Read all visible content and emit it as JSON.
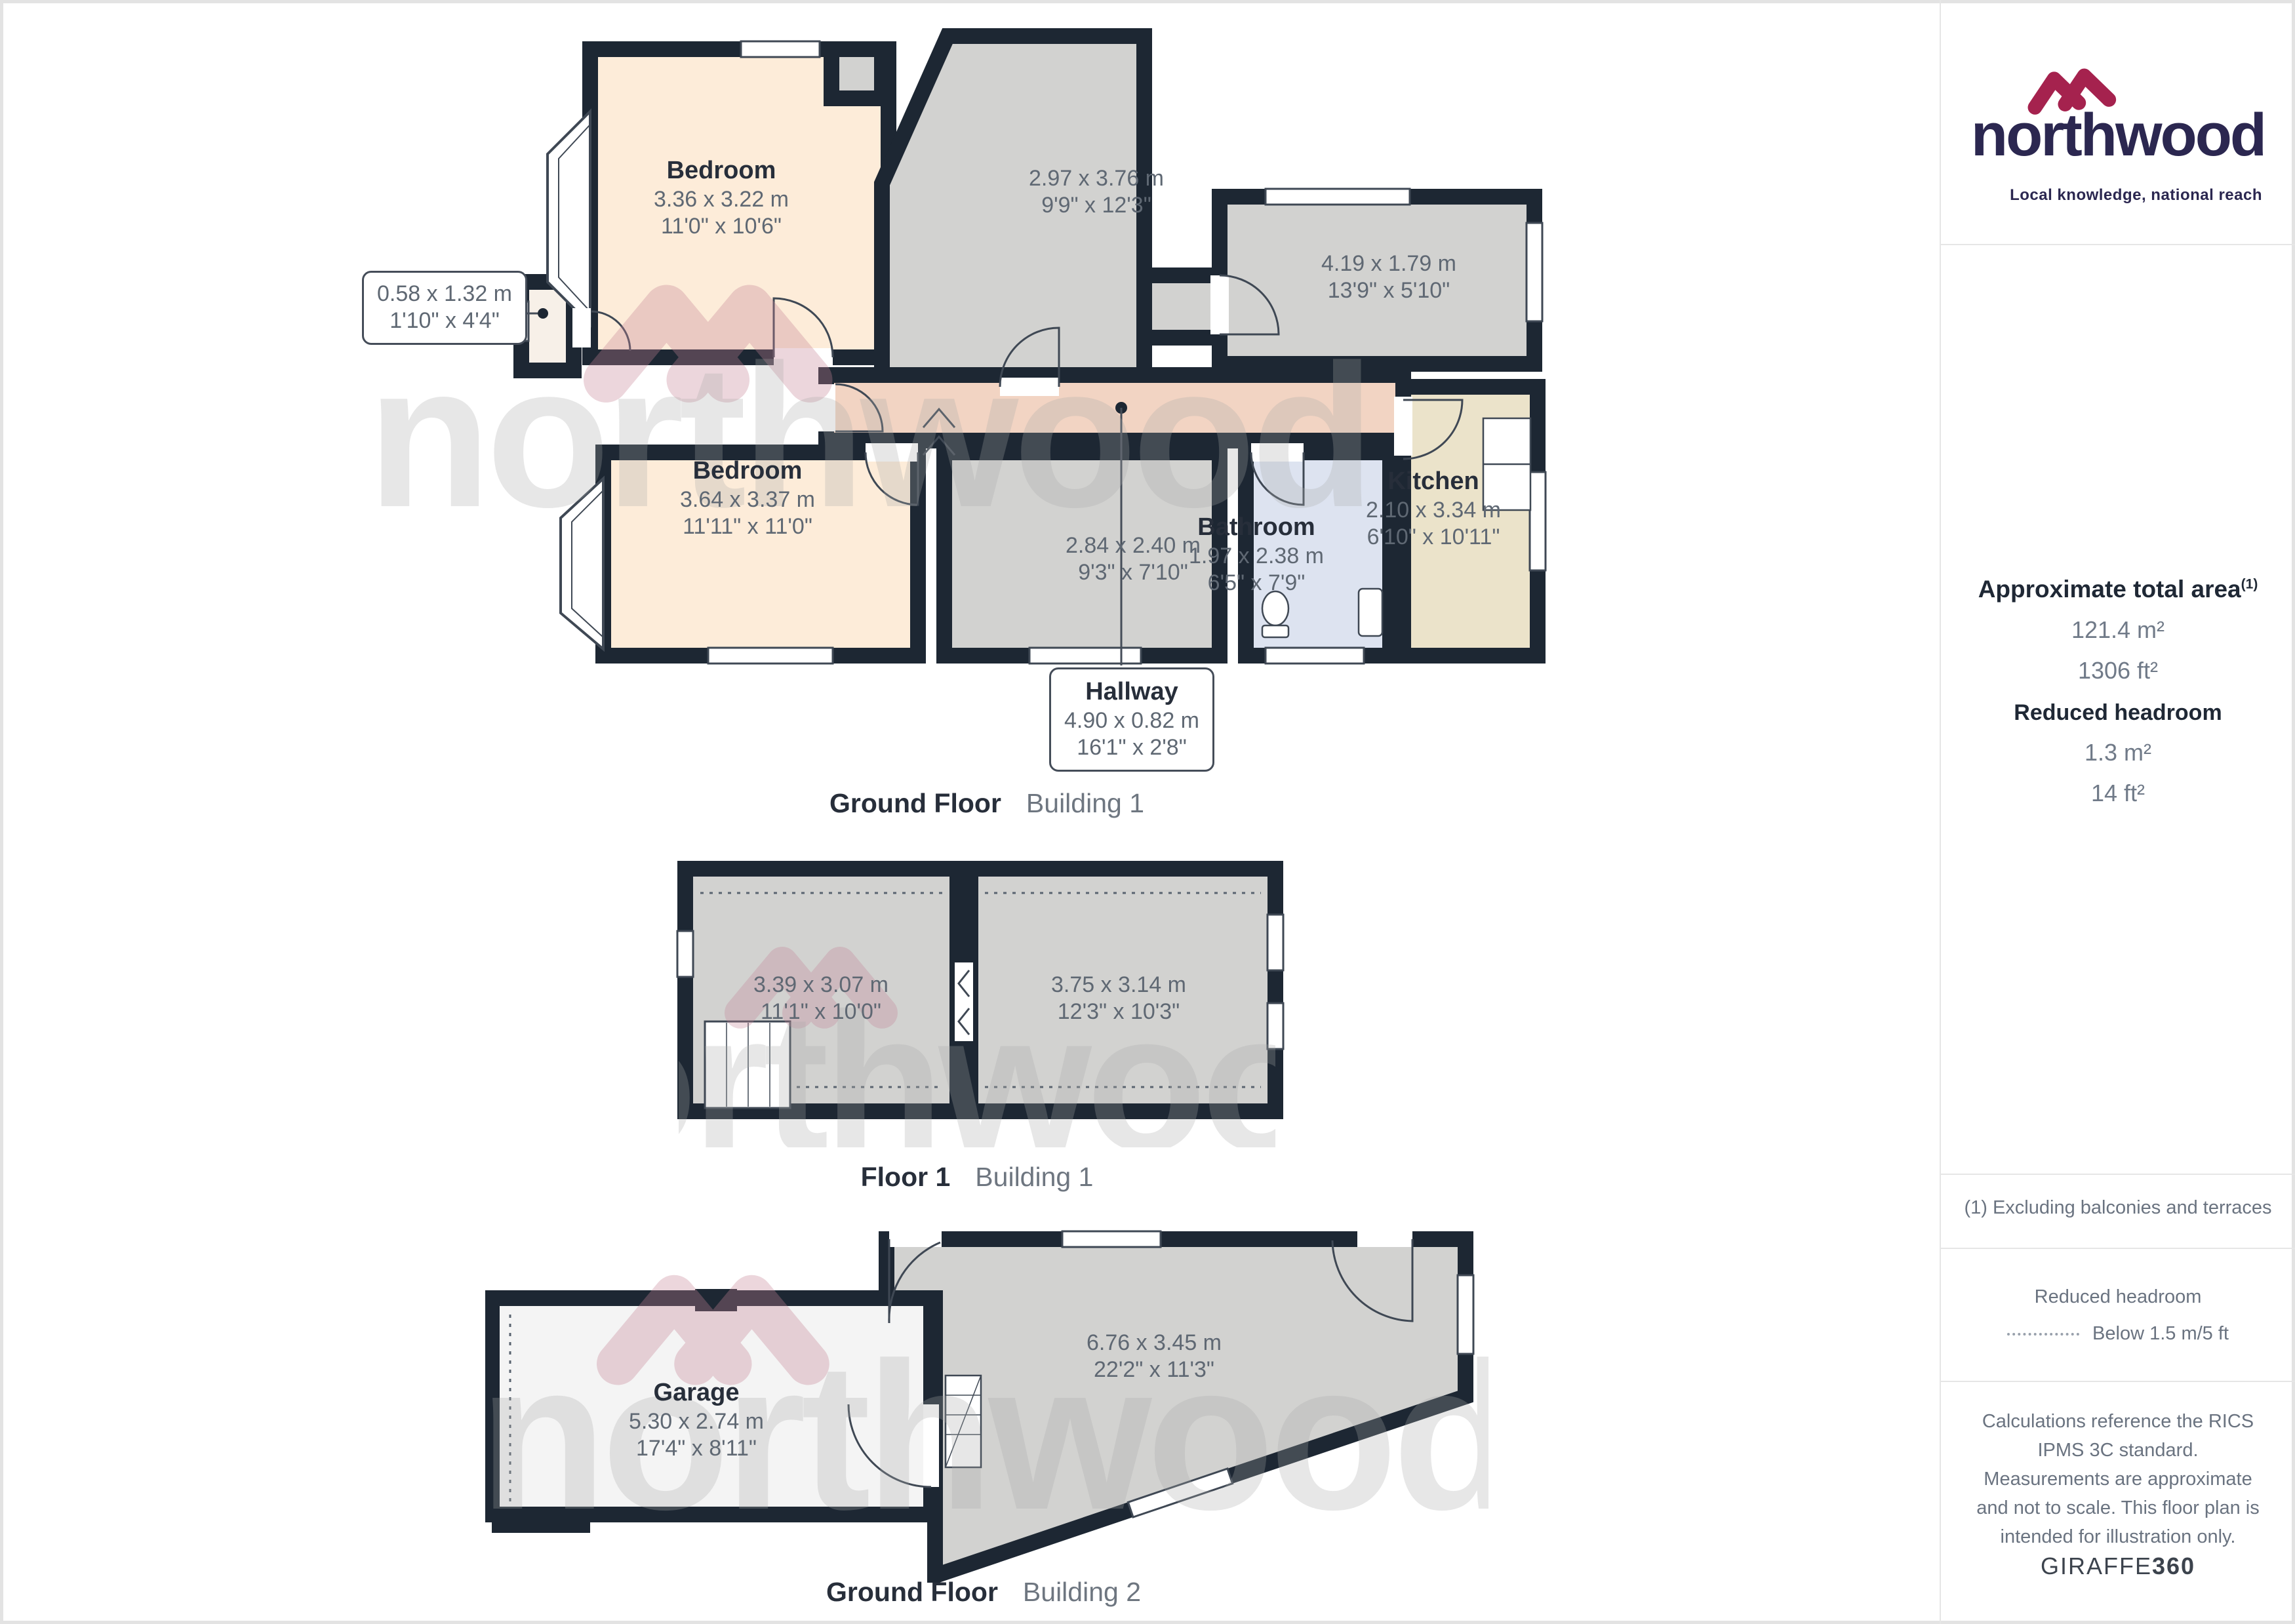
{
  "brand": {
    "name": "northwood",
    "tagline": "Local knowledge, national reach",
    "navy": "#2b2750",
    "crimson": "#a5224e"
  },
  "sidebar": {
    "total_area": {
      "title": "Approximate total area",
      "marker": "(1)",
      "metric": "121.4 m²",
      "imperial": "1306 ft²"
    },
    "reduced_headroom": {
      "title": "Reduced headroom",
      "metric": "1.3 m²",
      "imperial": "14 ft²"
    },
    "footnote": "(1) Excluding balconies and terraces",
    "legend": {
      "title": "Reduced headroom",
      "entry": "Below 1.5 m/5 ft"
    },
    "disclaimer": "Calculations reference the RICS IPMS 3C standard. Measurements are approximate and not to scale. This floor plan is intended for illustration only.",
    "credit_normal": "GIRAFFE",
    "credit_bold": "360"
  },
  "captions": [
    {
      "bold": "Ground Floor",
      "light": "Building 1"
    },
    {
      "bold": "Floor 1",
      "light": "Building 1"
    },
    {
      "bold": "Ground Floor",
      "light": "Building 2"
    }
  ],
  "rooms": {
    "gf1_bedroom1": {
      "name": "Bedroom",
      "metric": "3.36 x 3.22 m",
      "imperial": "11'0\" x 10'6\""
    },
    "gf1_room297": {
      "metric": "2.97 x 3.76 m",
      "imperial": "9'9\" x 12'3\""
    },
    "gf1_room419": {
      "metric": "4.19 x 1.79 m",
      "imperial": "13'9\" x 5'10\""
    },
    "gf1_wc": {
      "metric": "0.58 x 1.32 m",
      "imperial": "1'10\" x 4'4\""
    },
    "gf1_bedroom2": {
      "name": "Bedroom",
      "metric": "3.64 x 3.37 m",
      "imperial": "11'11\" x 11'0\""
    },
    "gf1_room284": {
      "metric": "2.84 x 2.40 m",
      "imperial": "9'3\" x 7'10\""
    },
    "gf1_bathroom": {
      "name": "Bathroom",
      "metric": "1.97 x 2.38 m",
      "imperial": "6'5\" x 7'9\""
    },
    "gf1_kitchen": {
      "name": "Kitchen",
      "metric": "2.10 x 3.34 m",
      "imperial": "6'10\" x 10'11\""
    },
    "gf1_hallway": {
      "name": "Hallway",
      "metric": "4.90 x 0.82 m",
      "imperial": "16'1\" x 2'8\""
    },
    "f1_room339": {
      "metric": "3.39 x 3.07 m",
      "imperial": "11'1\" x 10'0\""
    },
    "f1_room375": {
      "metric": "3.75 x 3.14 m",
      "imperial": "12'3\" x 10'3\""
    },
    "gf2_garage": {
      "name": "Garage",
      "metric": "5.30 x 2.74 m",
      "imperial": "17'4\" x 8'11\""
    },
    "gf2_room676": {
      "metric": "6.76 x 3.45 m",
      "imperial": "22'2\" x 11'3\""
    }
  },
  "palette": {
    "wall": "#1d2733",
    "room_gray": "#d2d2d0",
    "room_peach": "#fdecd9",
    "hallway_salmon": "#f2d4c3",
    "bathroom_blue": "#dde3f0",
    "kitchen_cream": "#ebe3ca",
    "garage_white": "#f4f4f4"
  }
}
